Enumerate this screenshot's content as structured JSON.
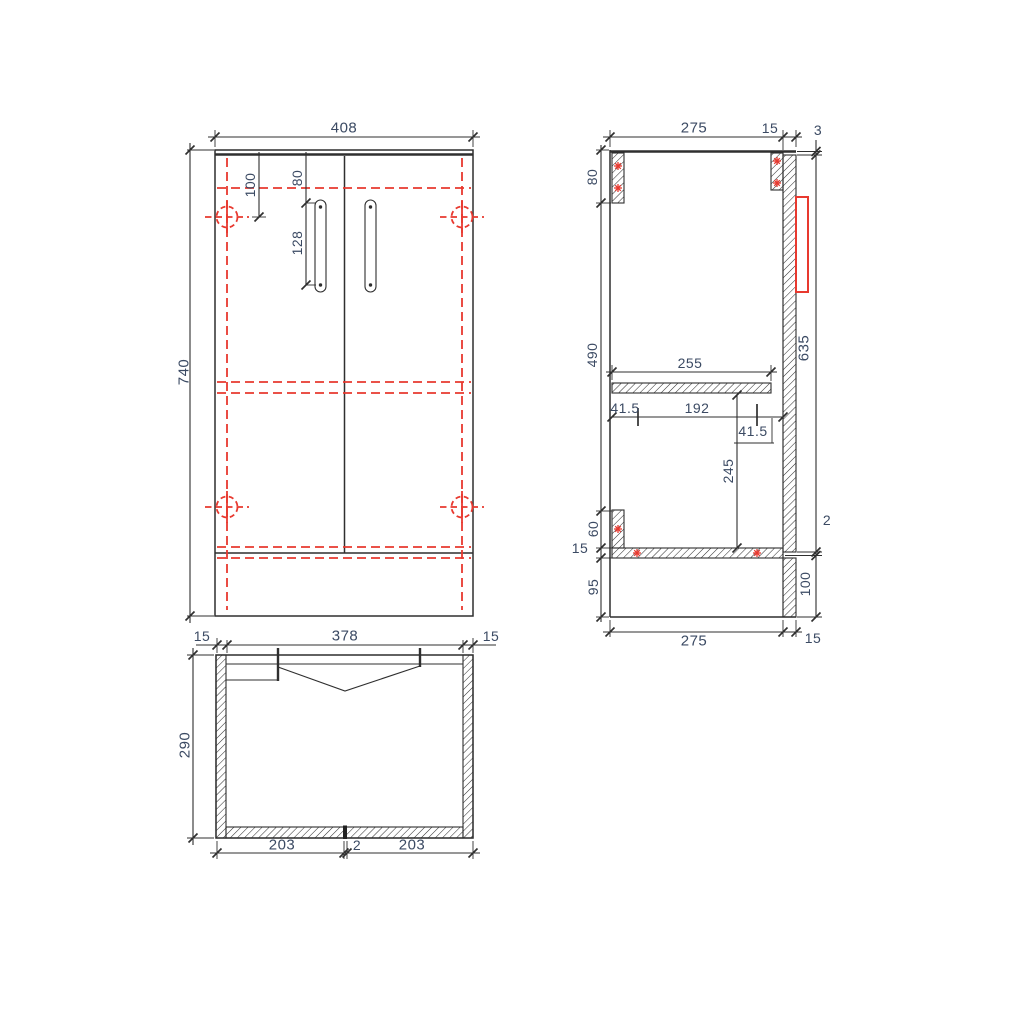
{
  "drawing": {
    "title": "cabinet-technical-drawing",
    "colors": {
      "line": "#2f2f2f",
      "hidden_and_hardware": "#e8392f",
      "dimension_text": "#3b4a63",
      "background": "#ffffff"
    },
    "front_view": {
      "overall_width": "408",
      "overall_height": "740",
      "hinge_center_from_top": "100",
      "handle_from_top": "80",
      "handle_length": "128"
    },
    "plan_view": {
      "panel_left": "15",
      "inner_width": "378",
      "panel_right": "15",
      "depth": "290",
      "door_left": "203",
      "door_gap": "2",
      "door_right": "203"
    },
    "side_view": {
      "depth_top": "275",
      "door_thickness_top": "15",
      "top_gap": "3",
      "back_rail_height": "80",
      "interior_height": "490",
      "bottom_rail_height": "60",
      "bottom_panel_thickness": "15",
      "plinth_height": "95",
      "door_height": "635",
      "bottom_gap": "2",
      "leg_height": "100",
      "shelf_depth": "255",
      "offset_back": "41.5",
      "dowel_spacing": "192",
      "offset_front": "41.5",
      "shelf_clearance": "245",
      "depth_bottom": "275",
      "door_thickness_bottom": "15"
    }
  }
}
